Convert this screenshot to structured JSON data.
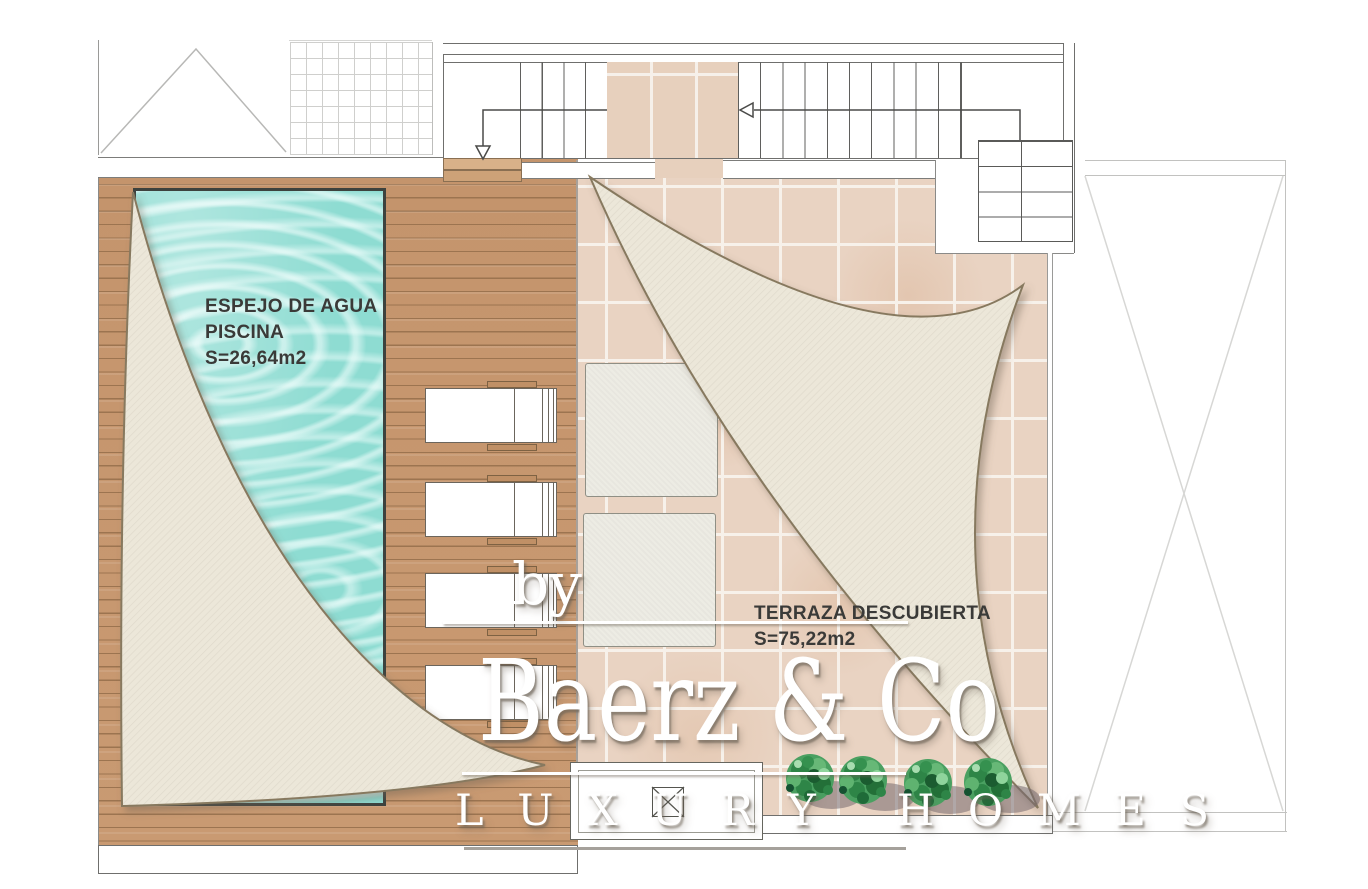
{
  "page": {
    "type": "Roof terrace architectural floor plan"
  },
  "plan": {
    "pool": {
      "label_line1": "ESPEJO DE AGUA",
      "label_line2": "PISCINA",
      "area": "S=26,64m2"
    },
    "terrace": {
      "label": "TERRAZA DESCUBIERTA",
      "area": "S=75,22m2"
    }
  },
  "watermark": {
    "prefix": "by",
    "brand": "Baerz & Co",
    "tagline": "L U X U R Y   H O M E S"
  },
  "colors": {
    "pool_water": "#8edcd2",
    "deck_wood": "#c4946c",
    "terrace_tile": "#e9d3c2",
    "sail_fabric": "#ece7d9",
    "foliage_green": "#3f9457",
    "watermark": "#ffffff"
  }
}
